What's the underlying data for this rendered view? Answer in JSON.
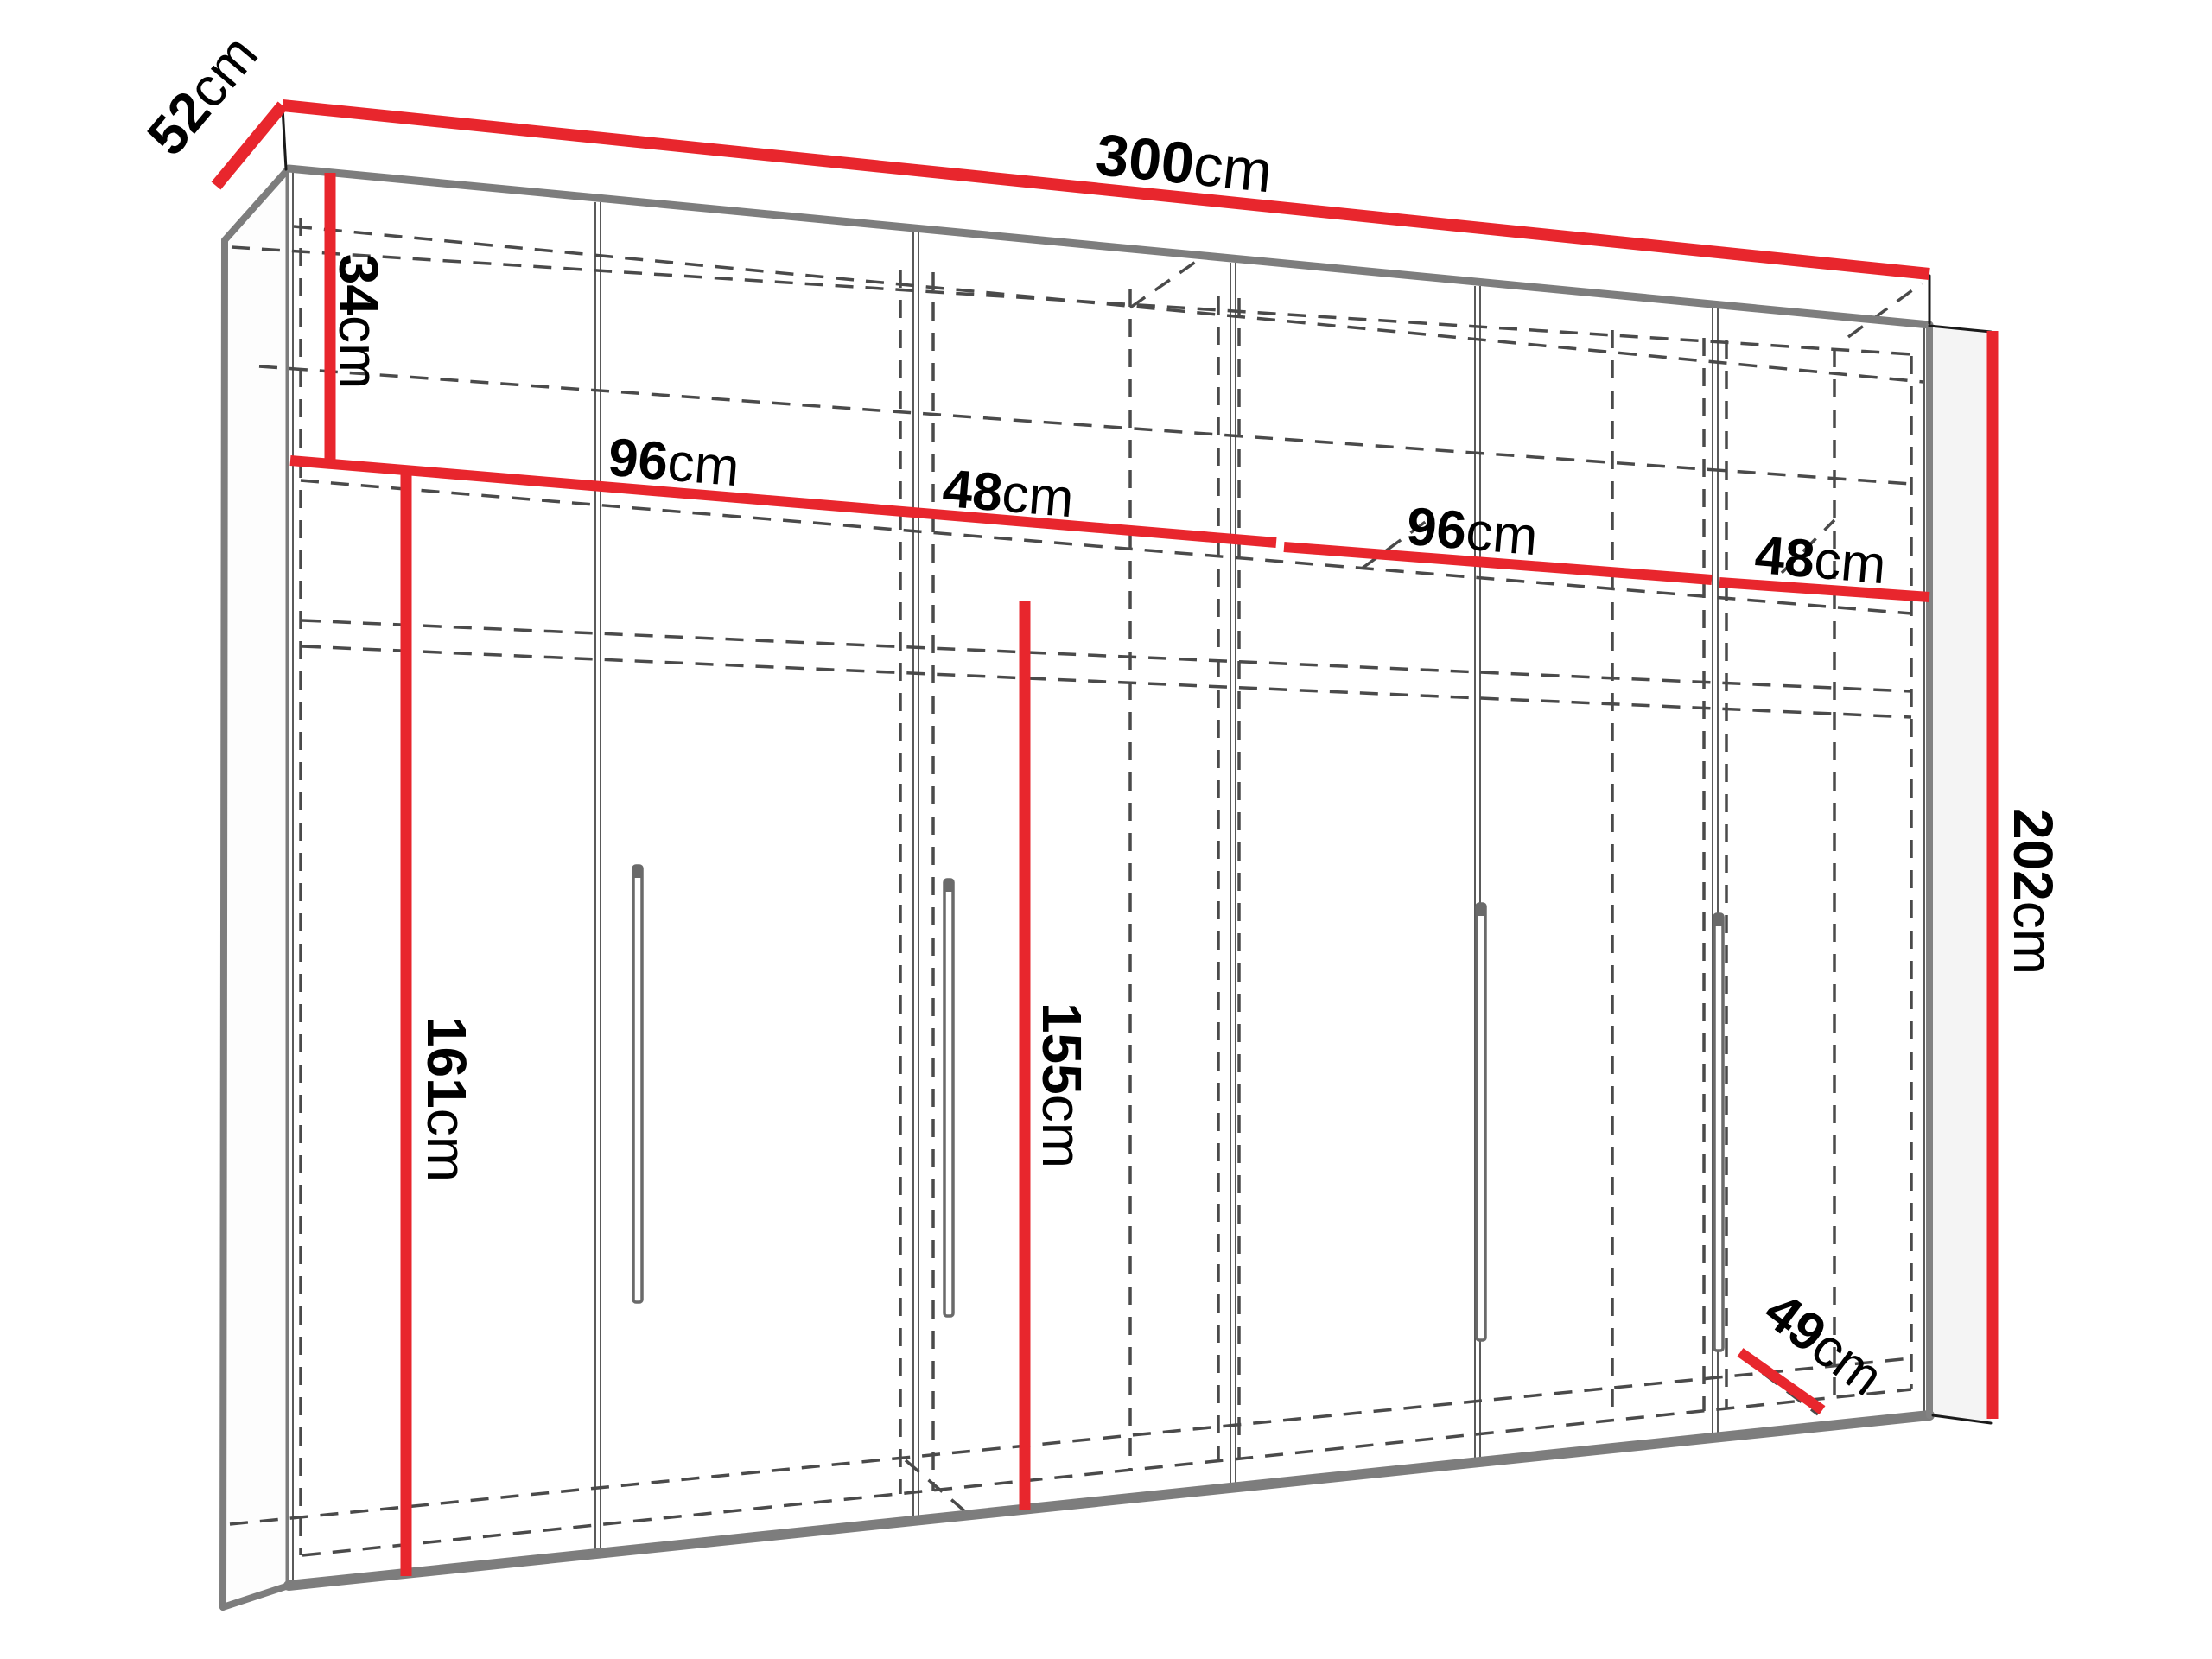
{
  "meta": {
    "title": "Wardrobe dimension diagram",
    "unit": "cm",
    "door_count": 6,
    "handle_count": 4
  },
  "colors": {
    "dimension_red": "#e8262d",
    "edge_gray": "#7d7d7d",
    "dashed_gray": "#4a4a4a",
    "thin_black": "#1a1a1a",
    "handle_gray": "#6a6a6a",
    "background": "#ffffff"
  },
  "dimensions": {
    "overall_width": {
      "value": "300",
      "unit": "cm"
    },
    "overall_height": {
      "value": "202",
      "unit": "cm"
    },
    "overall_depth": {
      "value": "52",
      "unit": "cm"
    },
    "top_shelf_height": {
      "value": "34",
      "unit": "cm"
    },
    "section_1_width": {
      "value": "96",
      "unit": "cm"
    },
    "section_2_width": {
      "value": "48",
      "unit": "cm"
    },
    "section_3_width": {
      "value": "96",
      "unit": "cm"
    },
    "section_4_width": {
      "value": "48",
      "unit": "cm"
    },
    "left_hanging_height": {
      "value": "161",
      "unit": "cm"
    },
    "right_hanging_height": {
      "value": "155",
      "unit": "cm"
    },
    "usable_bottom_depth": {
      "value": "49",
      "unit": "cm"
    }
  }
}
